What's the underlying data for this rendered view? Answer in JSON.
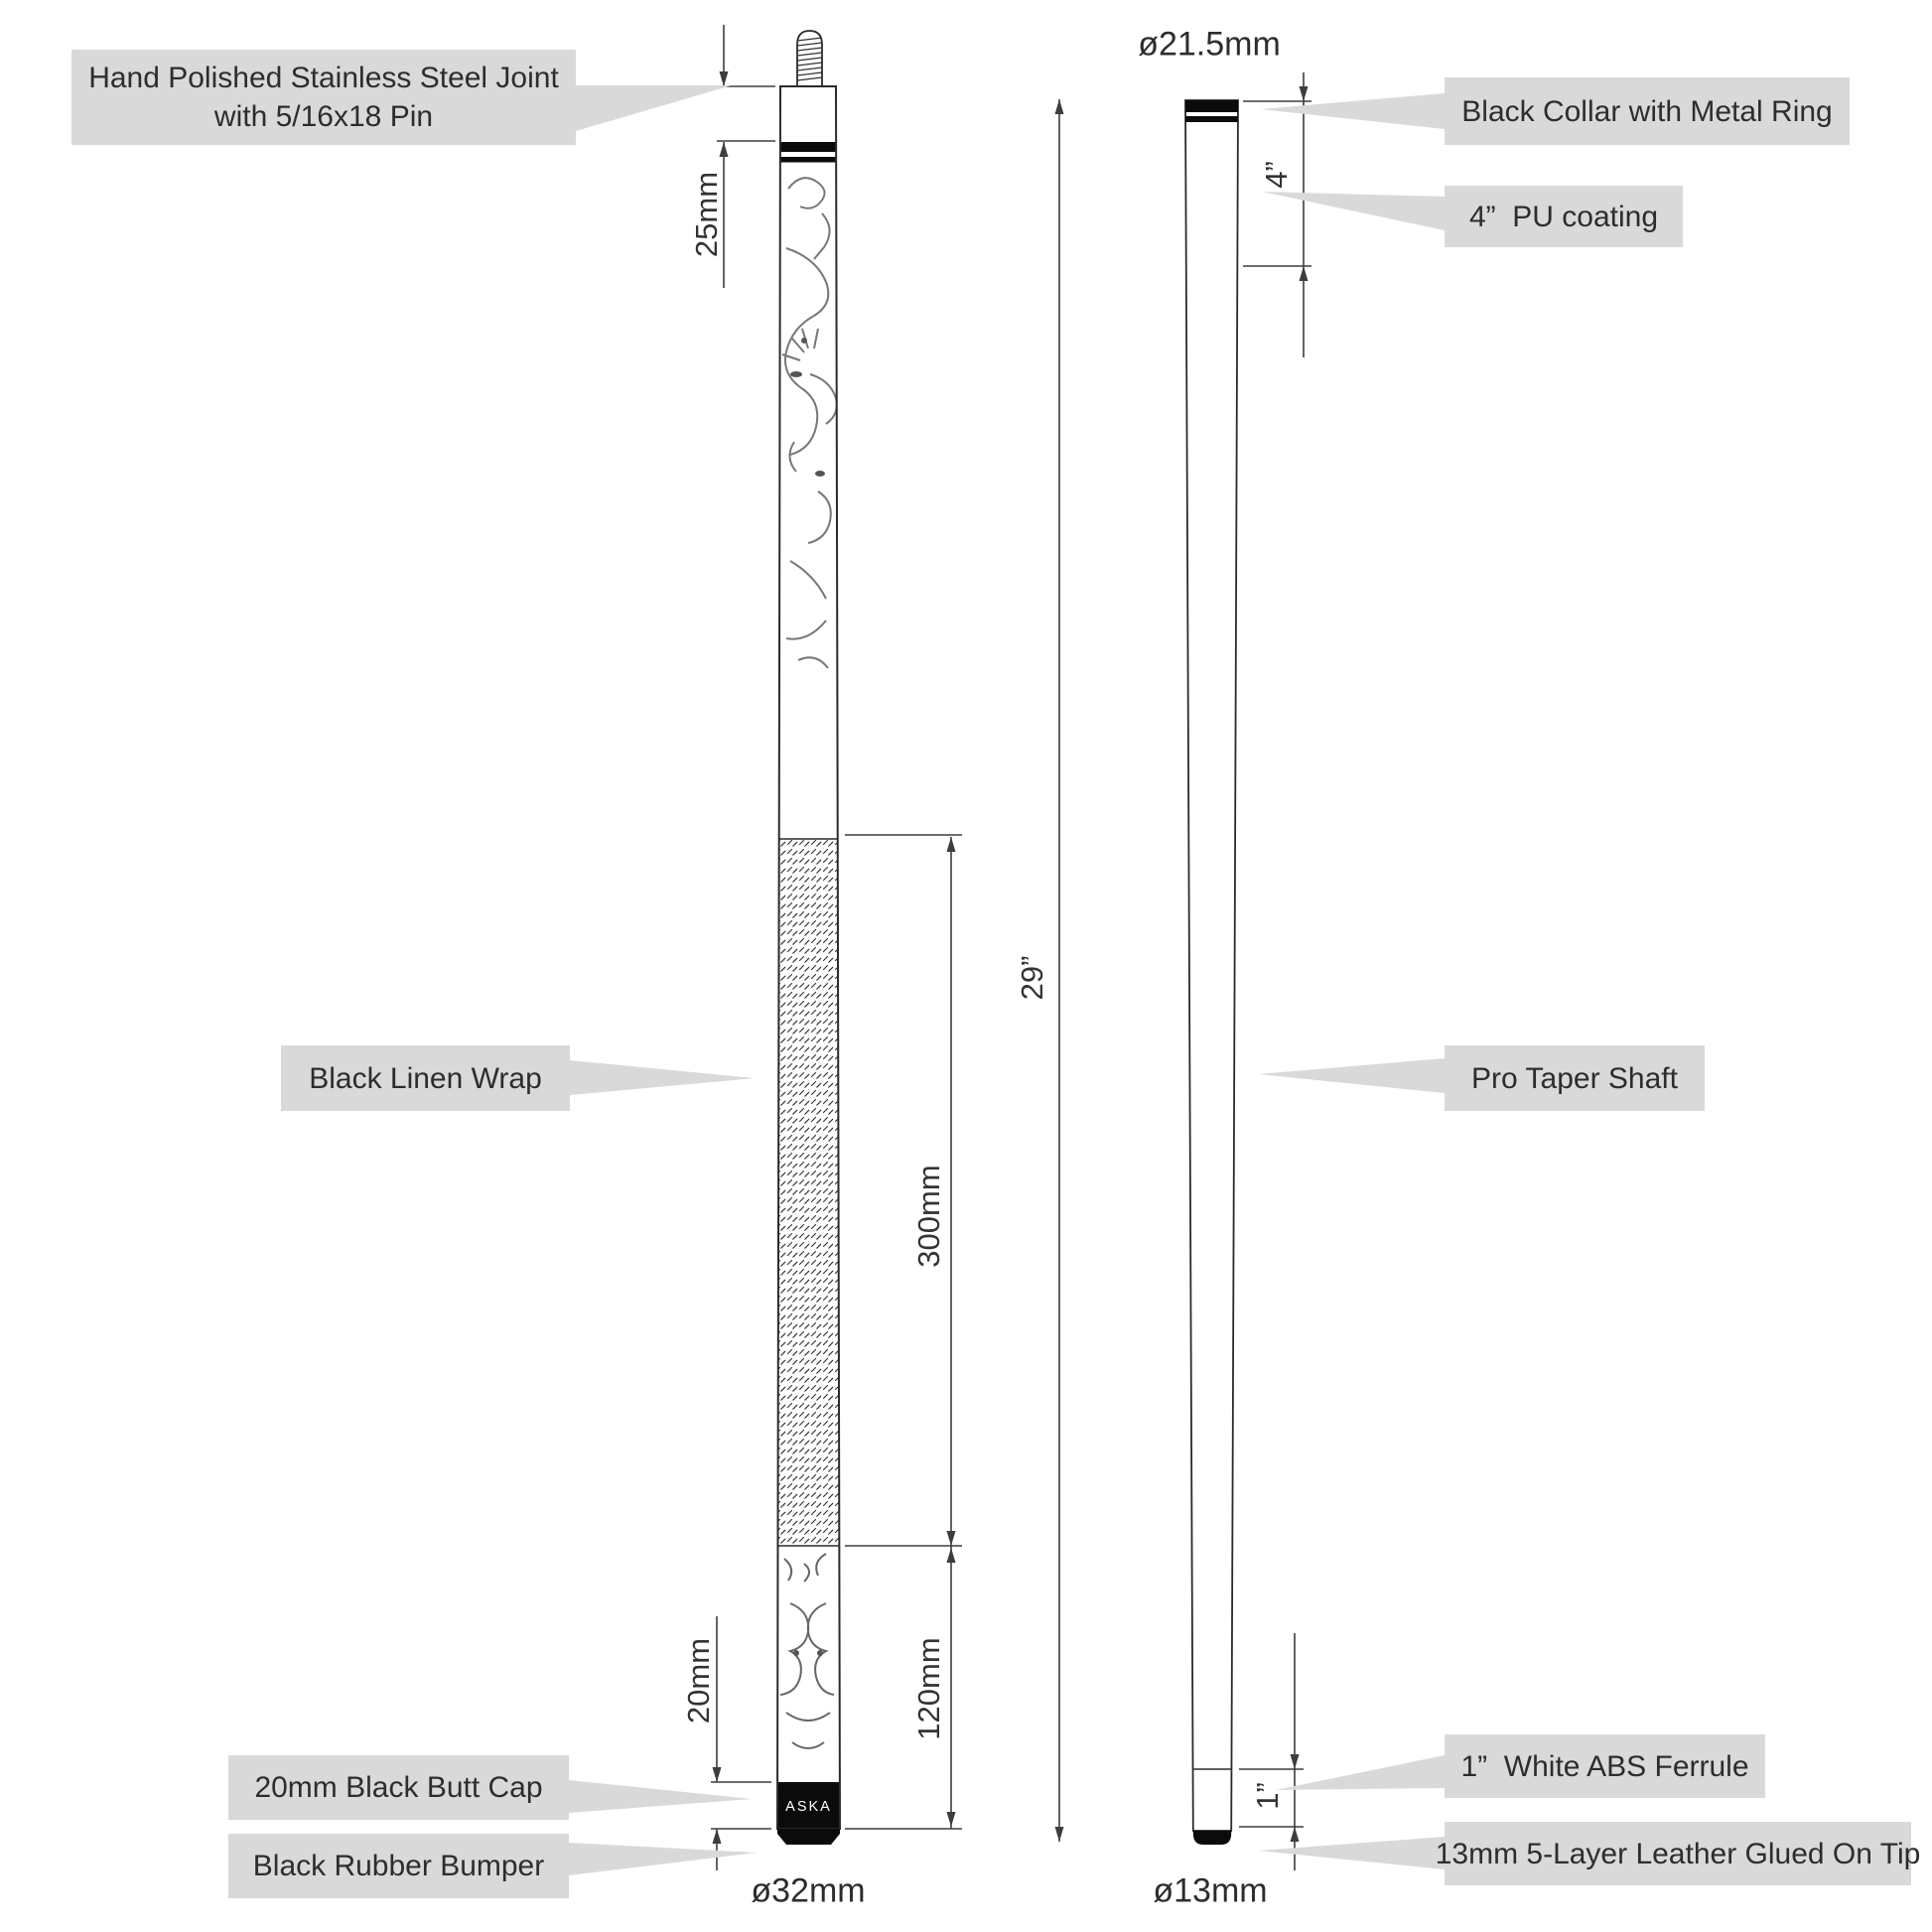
{
  "diagram": {
    "brand": "ASKA",
    "labels": {
      "joint_line1": "Hand Polished Stainless Steel Joint",
      "joint_line2": "with 5/16x18 Pin",
      "collar": "Black Collar with Metal Ring",
      "pu_coating": "4”  PU coating",
      "wrap": "Black Linen Wrap",
      "shaft": "Pro Taper Shaft",
      "butt_cap": "20mm Black Butt Cap",
      "bumper": "Black Rubber Bumper",
      "ferrule": "1”  White ABS Ferrule",
      "tip": "13mm 5-Layer Leather Glued On Tip"
    },
    "dimensions": {
      "collar_offset": "25mm",
      "wrap_length": "300mm",
      "sleeve_length": "120mm",
      "butt_cap_length": "20mm",
      "section_length": "29”",
      "pu_length": "4”",
      "ferrule_length": "1”"
    },
    "diameters": {
      "joint": "ø21.5mm",
      "butt": "ø32mm",
      "tip": "ø13mm"
    },
    "colors": {
      "callout_fill": "#d9d9d9",
      "ink": "#2d2d2d",
      "cue_black": "#0b0b0b",
      "dim_line": "#3d3d3d"
    }
  }
}
